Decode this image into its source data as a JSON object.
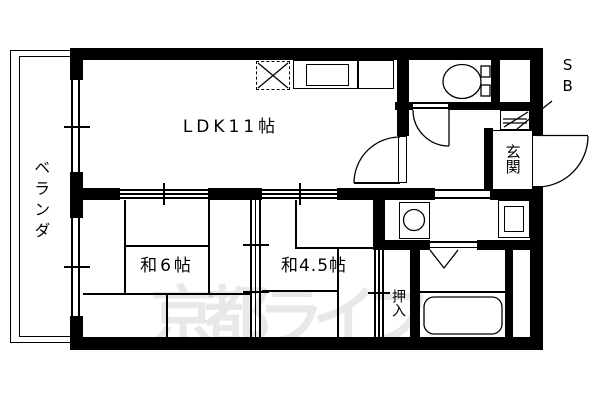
{
  "plan": {
    "labels": {
      "balcony": "ベランダ",
      "ldk": "LDK11帖",
      "tatami6": "和6帖",
      "tatami45": "和4.5帖",
      "closet": "押入",
      "entrance": "玄関",
      "shoe_box": "SB"
    },
    "watermark": "京都ライフ",
    "colors": {
      "line": "#000000",
      "background": "#ffffff",
      "watermark": "rgba(0,0,0,0.09)"
    },
    "symbols": {
      "range": "dashed-x-range-symbol",
      "kitchen_sink": "kitchen-sink-counter-symbol",
      "toilet": "toilet-plan-symbol",
      "shoe_cabinet": "shoe-cabinet-shelf-symbol",
      "washing_machine": "washing-machine-pan-symbol",
      "washbasin": "washbasin-symbol",
      "bathtub": "bathtub-symbol",
      "doors": [
        "swing-door-arc",
        "sliding-door-lines",
        "folding-door-v",
        "window-double-line"
      ]
    }
  }
}
